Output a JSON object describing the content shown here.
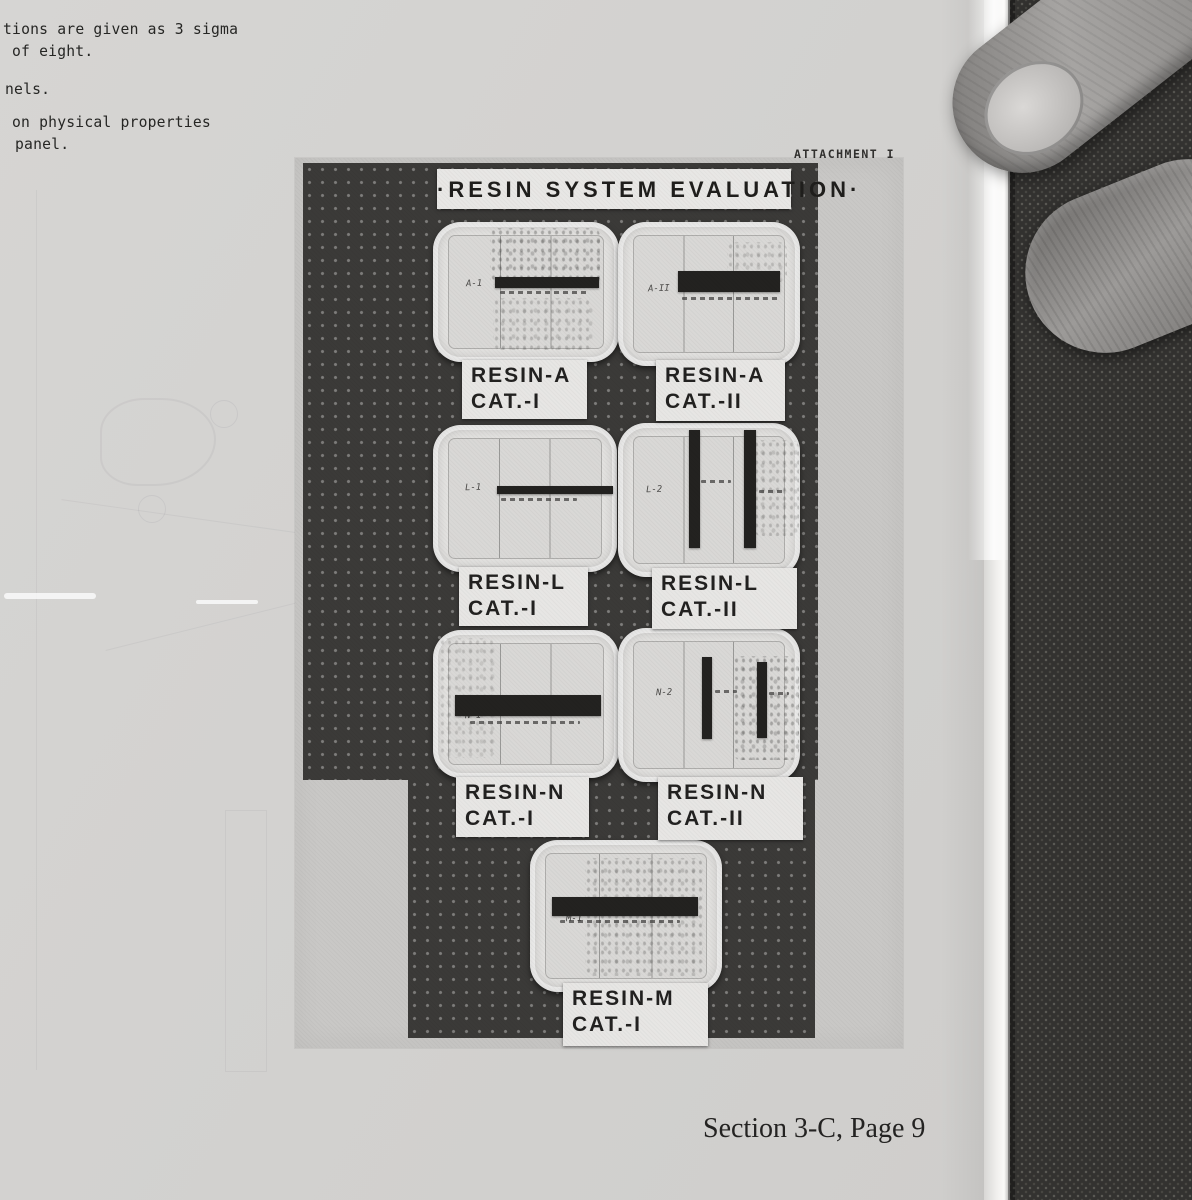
{
  "page": {
    "margin_lines": [
      "tions are given as 3 sigma",
      "of eight.",
      "nels.",
      "on physical properties",
      "panel."
    ],
    "attachment_label": "ATTACHMENT I",
    "footer_text": "Section 3-C, Page 9"
  },
  "photo": {
    "title": "·RESIN SYSTEM EVALUATION·",
    "panels": [
      {
        "mark": "A-1",
        "label_line1": "RESIN-A",
        "label_line2": "CAT.-I"
      },
      {
        "mark": "A-II",
        "label_line1": "RESIN-A",
        "label_line2": "CAT.-II"
      },
      {
        "mark": "L-1",
        "label_line1": "RESIN-L",
        "label_line2": "CAT.-I"
      },
      {
        "mark": "L-2",
        "label_line1": "RESIN-L",
        "label_line2": "CAT.-II"
      },
      {
        "mark": "N-1",
        "label_line1": "RESIN-N",
        "label_line2": "CAT.-I"
      },
      {
        "mark": "N-2",
        "label_line1": "RESIN-N",
        "label_line2": "CAT.-II"
      },
      {
        "mark": "M-1",
        "label_line1": "RESIN-M",
        "label_line2": "CAT.-I"
      }
    ]
  },
  "colors": {
    "page_bg": "#d3d2d0",
    "photo_print": "#c9c8c6",
    "pegboard_dark": "#3b3a38",
    "panel_tray": "#e3e2e0",
    "specimen_bar": "#232220",
    "label_card": "#e7e6e4",
    "fabric": "#333230",
    "hand": "#a6a4a2"
  }
}
